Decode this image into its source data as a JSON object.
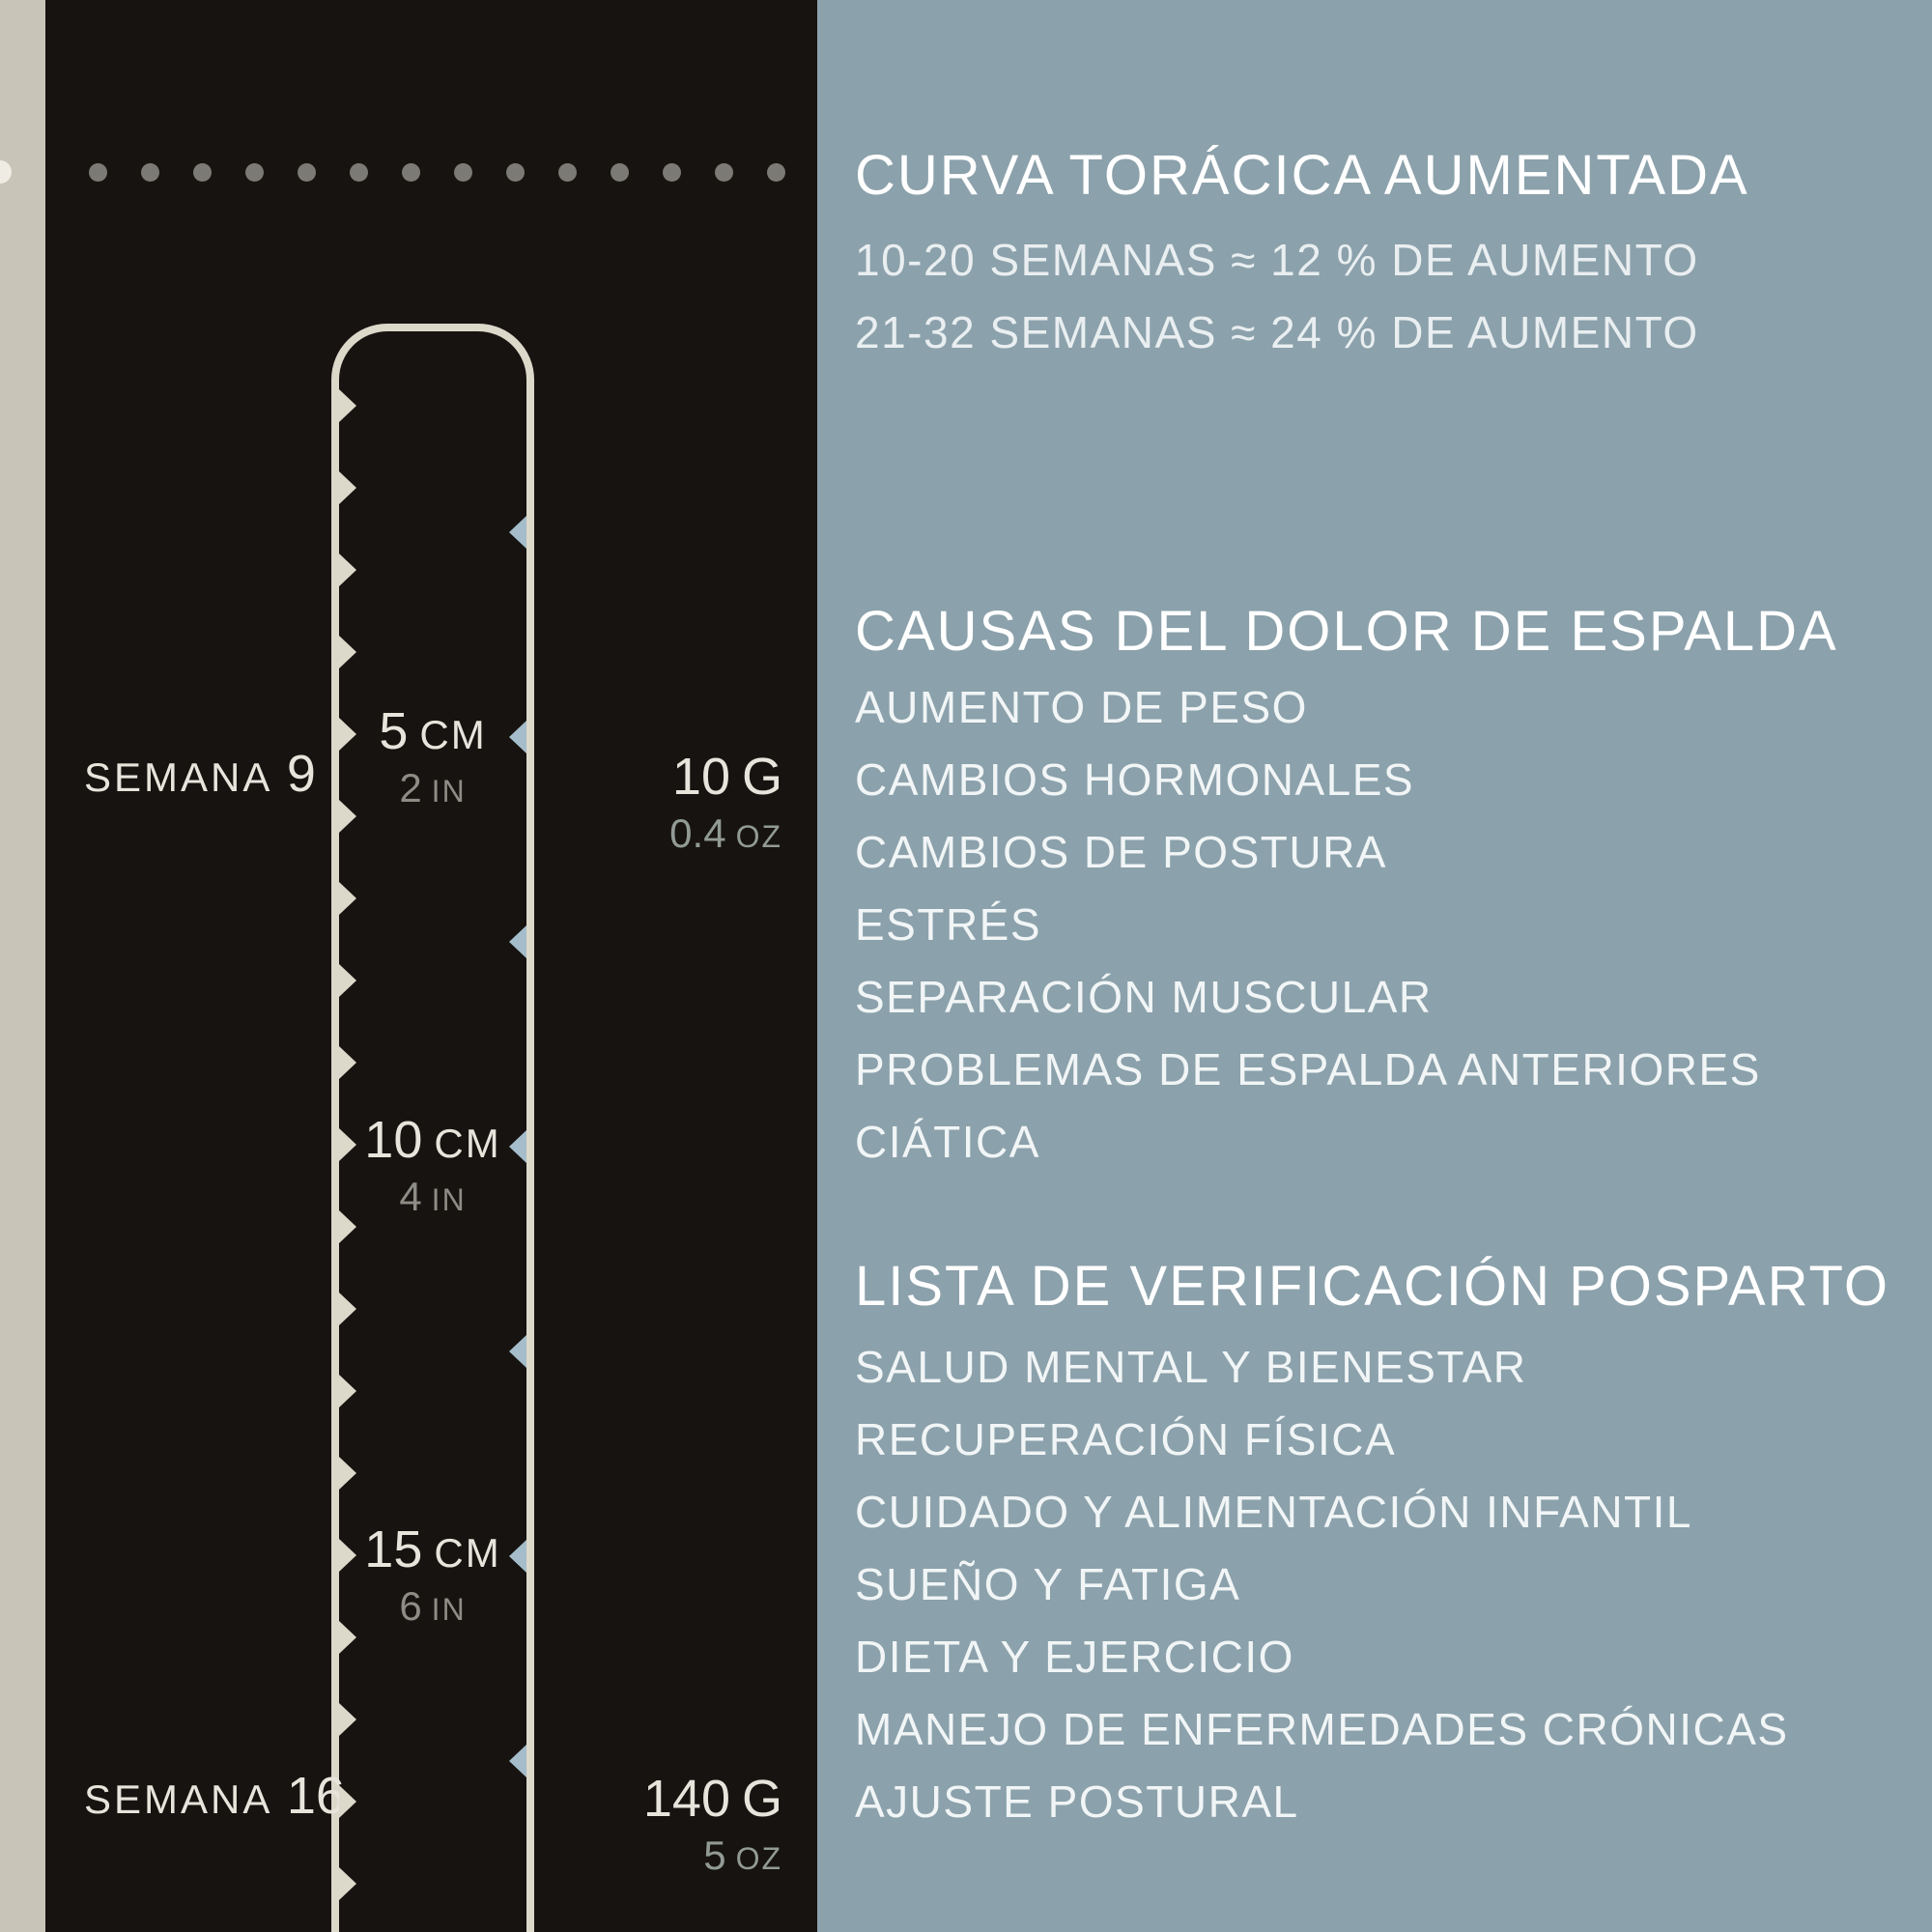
{
  "colors": {
    "dark": "#161310",
    "beige": "#c8c4b7",
    "blue": "#8ba1ab",
    "cream": "#dcd8ca",
    "cream-bright": "#efece3",
    "cream-text": "#e7e4dc",
    "gray-alt": "#8d8c85",
    "oz-gray": "#929a96",
    "tick-blue": "#a5bdca",
    "dot": "#7b7a74",
    "heading": "#ffffff",
    "subline": "#e9eef0",
    "item": "#f1f5f6"
  },
  "dark_panel": {
    "week_markers": [
      {
        "label": "SEMANA",
        "number": "9"
      },
      {
        "label": "SEMANA",
        "number": "16"
      }
    ],
    "length_labels": [
      {
        "value": "5",
        "unit": "CM",
        "alt_value": "2",
        "alt_unit": "IN"
      },
      {
        "value": "10",
        "unit": "CM",
        "alt_value": "4",
        "alt_unit": "IN"
      },
      {
        "value": "15",
        "unit": "CM",
        "alt_value": "6",
        "alt_unit": "IN"
      }
    ],
    "weight_labels": [
      {
        "value": "10",
        "unit": "G",
        "alt_value": "0.4",
        "alt_unit": "OZ"
      },
      {
        "value": "140",
        "unit": "G",
        "alt_value": "5",
        "alt_unit": "OZ"
      }
    ]
  },
  "right_panel": {
    "sections": [
      {
        "title": "CURVA TORÁCICA AUMENTADA",
        "lines": [
          "10-20 SEMANAS ≈ 12 % DE AUMENTO",
          "21-32 SEMANAS ≈ 24 % DE AUMENTO"
        ]
      },
      {
        "title": "CAUSAS DEL DOLOR DE ESPALDA",
        "items": [
          "AUMENTO DE PESO",
          "CAMBIOS HORMONALES",
          "CAMBIOS DE POSTURA",
          "ESTRÉS",
          "SEPARACIÓN MUSCULAR",
          "PROBLEMAS DE ESPALDA ANTERIORES",
          "CIÁTICA"
        ]
      },
      {
        "title": "LISTA DE VERIFICACIÓN POSPARTO",
        "items": [
          "SALUD MENTAL Y BIENESTAR",
          "RECUPERACIÓN FÍSICA",
          "CUIDADO Y ALIMENTACIÓN INFANTIL",
          "SUEÑO Y FATIGA",
          "DIETA Y EJERCICIO",
          "MANEJO DE ENFERMEDADES CRÓNICAS",
          "AJUSTE POSTURAL"
        ]
      }
    ]
  }
}
